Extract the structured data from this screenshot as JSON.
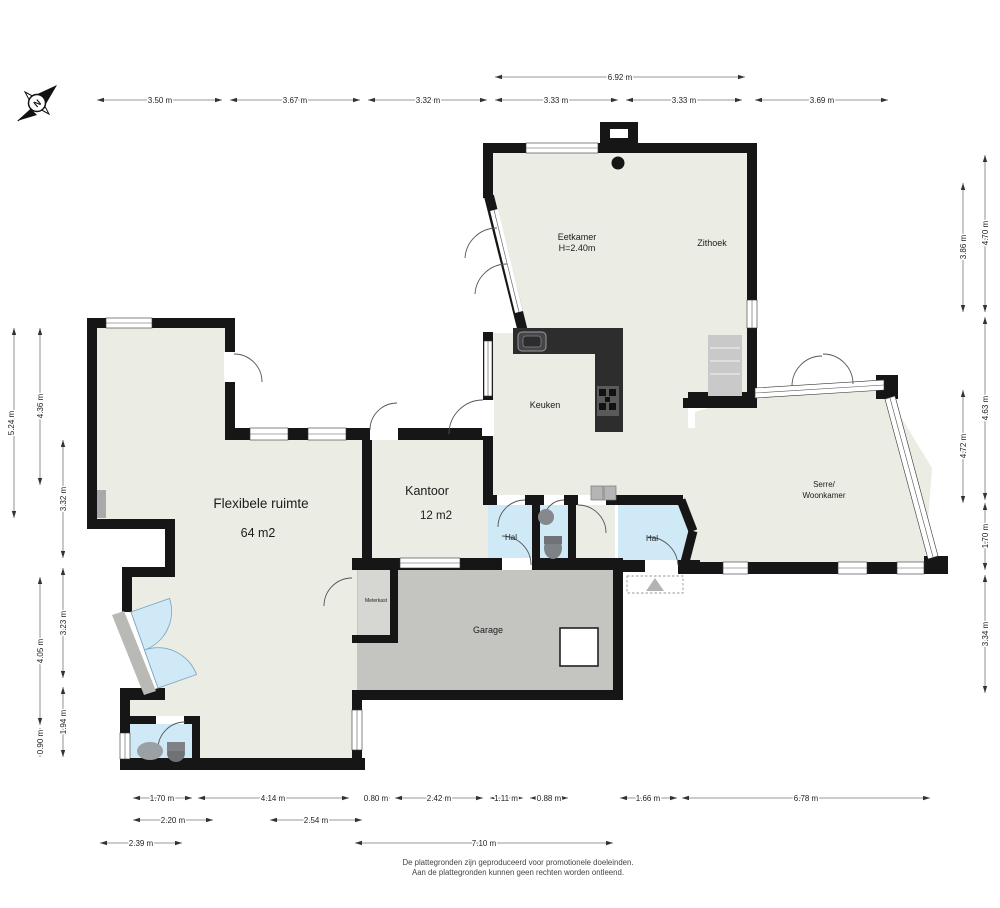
{
  "compass": {
    "letter": "N"
  },
  "rooms": {
    "eetkamer": {
      "name": "Eetkamer",
      "height_note": "H=2.40m"
    },
    "zithoek": {
      "name": "Zithoek"
    },
    "keuken": {
      "name": "Keuken"
    },
    "kantoor": {
      "name": "Kantoor",
      "area": "12 m2"
    },
    "flexibele": {
      "name": "Flexibele ruimte",
      "area": "64 m2"
    },
    "hal1": {
      "name": "Hal"
    },
    "hal2": {
      "name": "Hal"
    },
    "garage": {
      "name": "Garage"
    },
    "meterkast": {
      "name": "Meterkast"
    },
    "serre": {
      "line1": "Serre/",
      "line2": "Woonkamer"
    }
  },
  "dimensions": {
    "top_overall": "6.92 m",
    "top_row": [
      "3.50 m",
      "3.67 m",
      "3.32 m",
      "3.33 m",
      "3.33 m",
      "3.69 m"
    ],
    "left_outer": "5.24 m",
    "left_mid": [
      "4.36 m",
      "4.05 m",
      "0.90 m"
    ],
    "left_inner": [
      "3.32 m",
      "3.23 m",
      "1.94 m"
    ],
    "right_inner": [
      "3.86 m",
      "4.72 m"
    ],
    "right_outer": [
      "4.70 m",
      "4.63 m",
      "1.70 m",
      "3.34 m"
    ],
    "bottom_row1": [
      "1.70 m",
      "4.14 m",
      "0.80 m",
      "2.42 m",
      "1.11 m",
      "0.88 m",
      "1.66 m",
      "6.78 m"
    ],
    "bottom_row2": [
      "2.20 m",
      "2.54 m"
    ],
    "bottom_row3": [
      "2.39 m",
      "7.10 m"
    ]
  },
  "footer": {
    "line1": "De plattegronden zijn geproduceerd voor promotionele doeleinden.",
    "line2": "Aan de plattegronden kunnen geen rechten worden ontleend."
  },
  "colors": {
    "wall": "#161616",
    "floor": "#ebece3",
    "hal": "#cfe9f7",
    "garage": "#c4c5c1",
    "counter": "#2d2d2d"
  }
}
